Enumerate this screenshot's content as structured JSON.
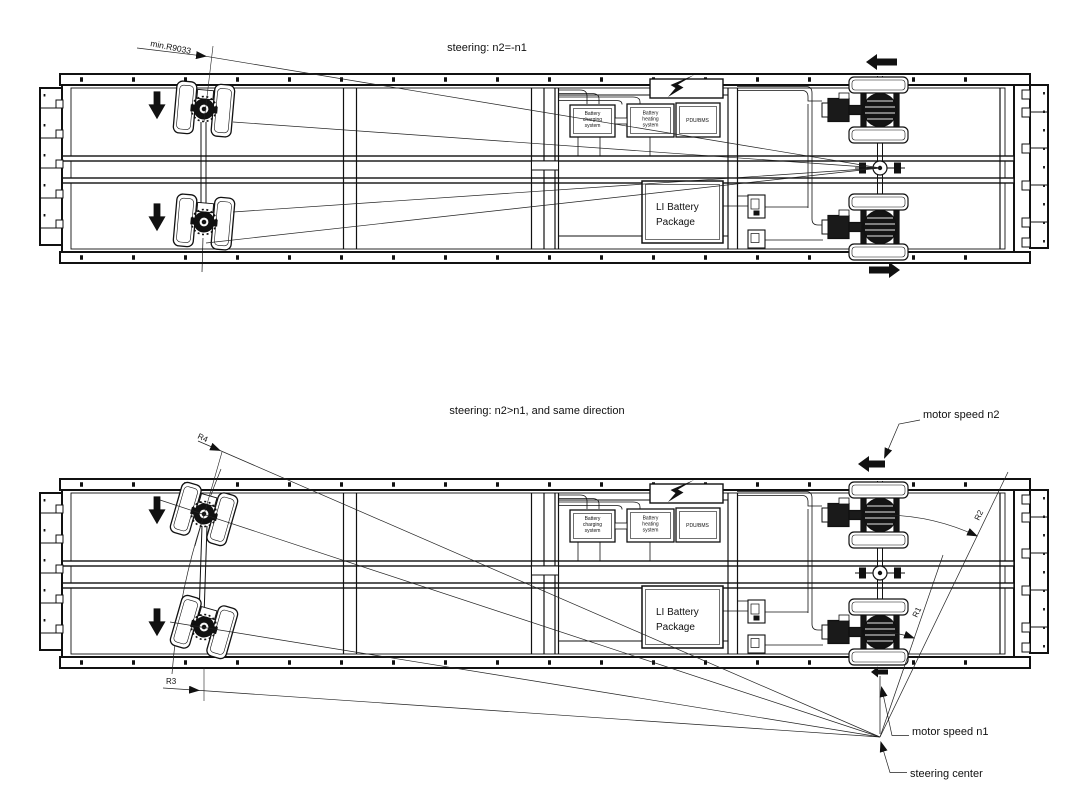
{
  "figure": {
    "background_color": "#ffffff",
    "line_color": "#111111",
    "description_note": "technical plan-view drawing of a self-propelled trailer chassis shown in two steering modes"
  },
  "top_diagram": {
    "title": "steering: n2=-n1",
    "min_radius_label": "min.R9033"
  },
  "bottom_diagram": {
    "title": "steering: n2>n1, and  same direction",
    "radius_labels": {
      "r1": "R1",
      "r2": "R2",
      "r3": "R3",
      "r4": "R4"
    },
    "motor_speed_n2_label": "motor speed n2",
    "motor_speed_n1_label": "motor speed n1",
    "steering_center_label": "steering center"
  },
  "equipment": {
    "battery_charging": {
      "line1": "Battery",
      "line2": "charging",
      "line3": "system"
    },
    "battery_heating": {
      "line1": "Battery",
      "line2": "heating",
      "line3": "system"
    },
    "pdu_bms": "PDU/BMS",
    "li_battery": {
      "line1": "LI Battery",
      "line2": "Package"
    }
  }
}
